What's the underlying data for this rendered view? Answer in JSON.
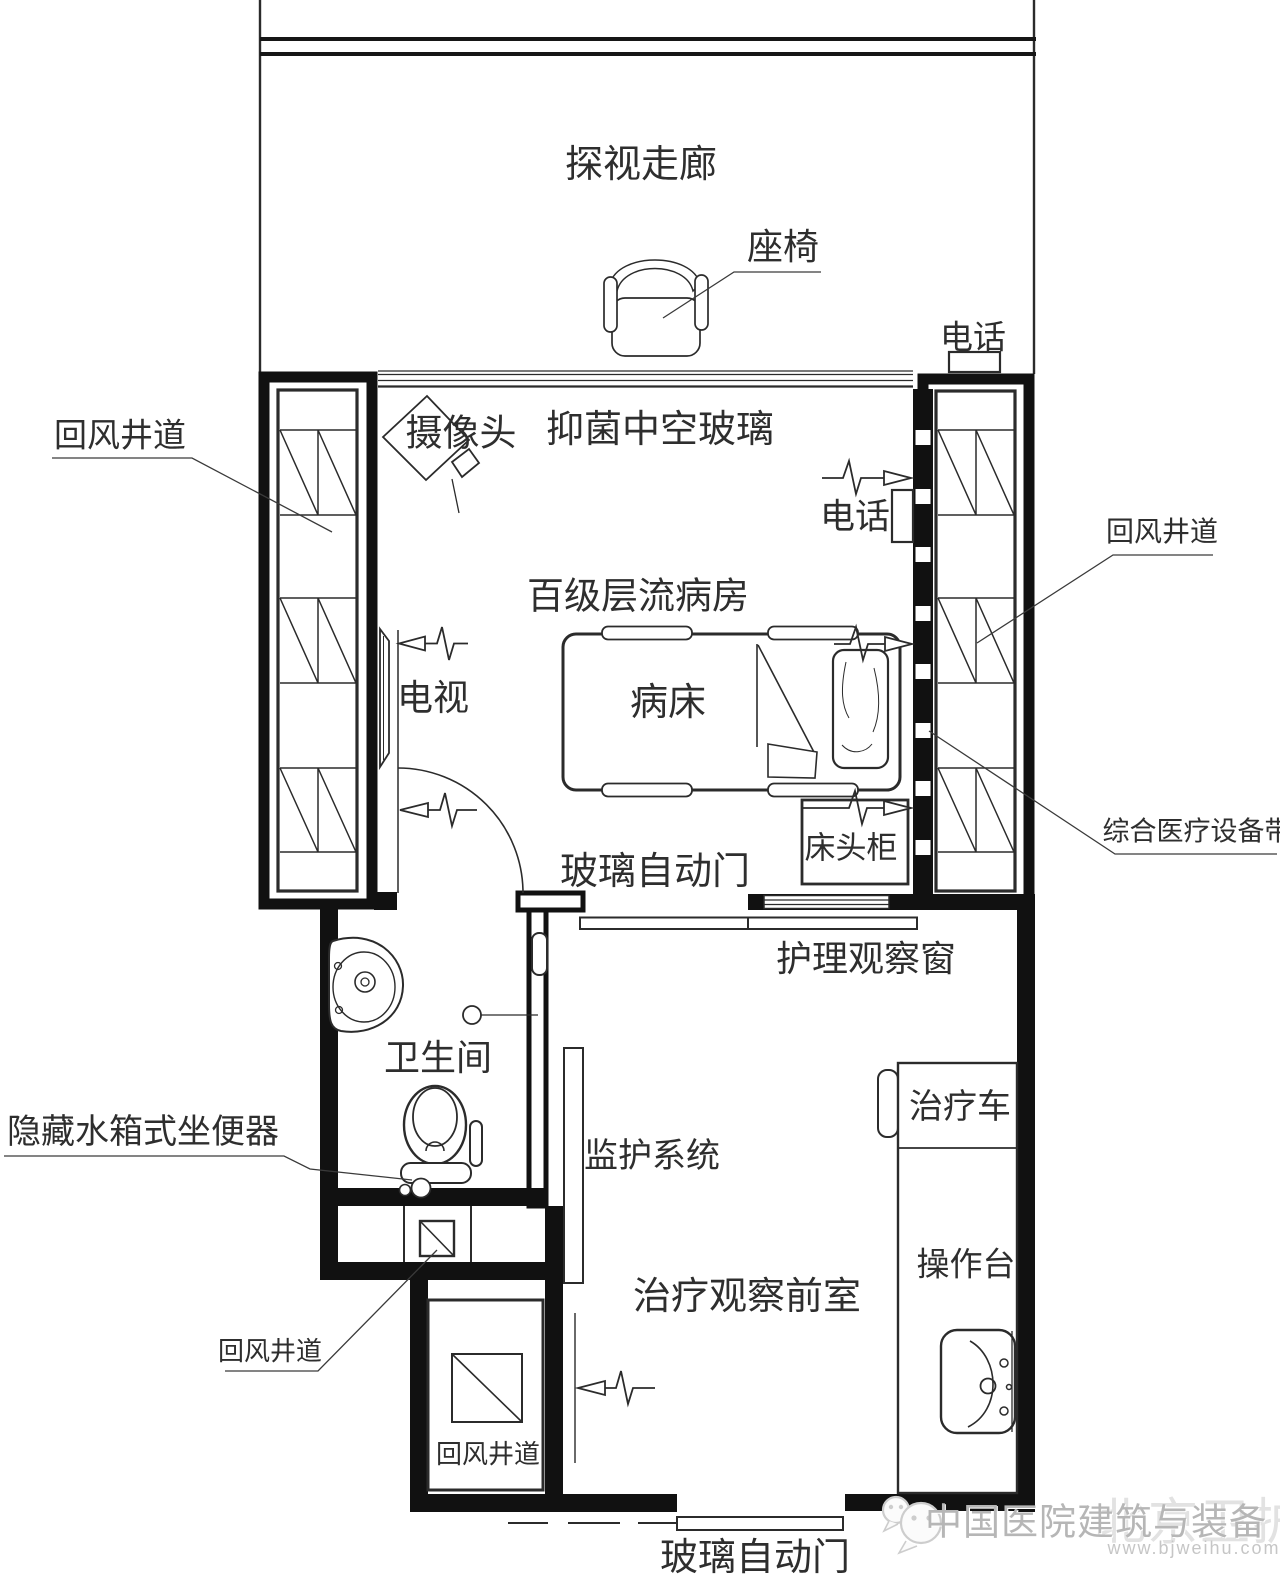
{
  "corridor": {
    "label": "探视走廊",
    "chair_label": "座椅",
    "phone_label": "电话"
  },
  "ward": {
    "room_label": "百级层流病房",
    "glass_label": "抑菌中空玻璃",
    "camera_label": "摄像头",
    "tv_label": "电视",
    "phone_label": "电话",
    "bed_label": "病床",
    "cabinet_label": "床头柜",
    "door_label": "玻璃自动门",
    "window_label": "护理观察窗",
    "equipment_belt_label": "综合医疗设备带"
  },
  "air_shafts": {
    "left_label": "回风井道",
    "right_label": "回风井道",
    "lower_left_label": "回风井道",
    "lower_shaft_label": "回风井道"
  },
  "bathroom": {
    "room_label": "卫生间",
    "toilet_label": "隐藏水箱式坐便器"
  },
  "anteroom": {
    "room_label": "治疗观察前室",
    "monitor_label": "监护系统",
    "cart_label": "治疗车",
    "worktop_label": "操作台",
    "door_label": "玻璃自动门"
  },
  "watermark": {
    "brand": "中国医院建筑与装备",
    "overlay": "北京卫护",
    "url": "www.bjweihu.com"
  }
}
